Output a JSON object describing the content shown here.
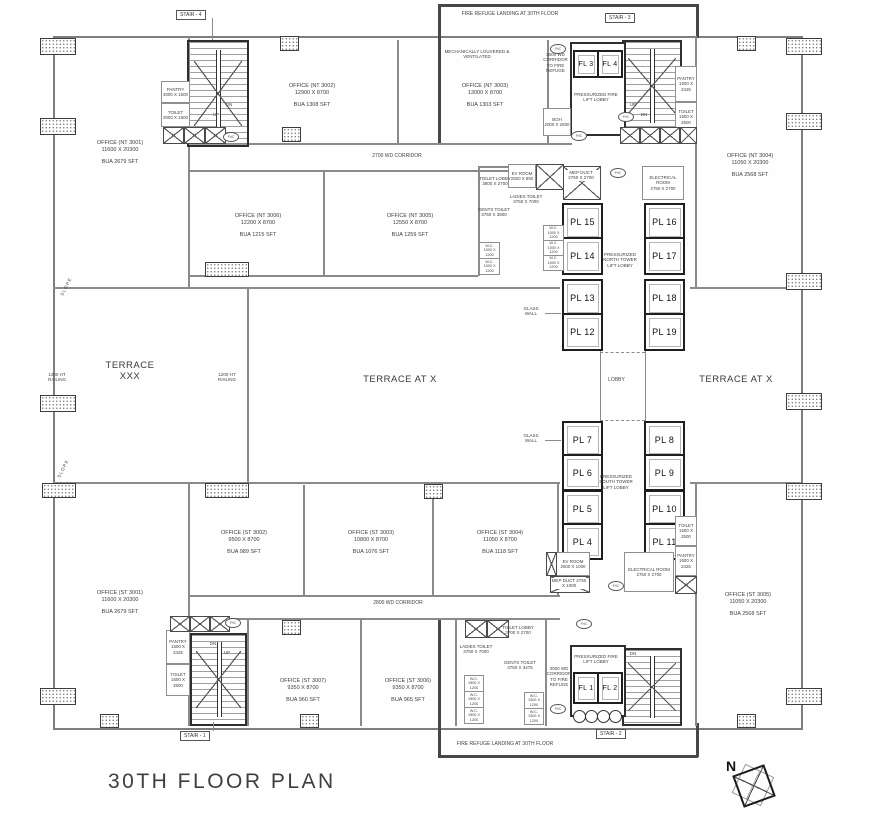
{
  "title": "30TH FLOOR PLAN",
  "north": {
    "label": "N"
  },
  "refuge": {
    "top": "FIRE REFUGE LANDING AT 30TH FLOOR",
    "bottom": "FIRE REFUGE LANDING AT 30TH FLOOR"
  },
  "corridors": {
    "top": "2700 WD CORRIDOR",
    "bottom": "2800 WD CORRIDOR",
    "fire_top": "3000 WD CORRIDOR TO FIRE REFUGE",
    "fire_bottom": "3000 WD CORRIDOR TO FIRE REFUGE"
  },
  "stairs": {
    "s1": "STAIR - 1",
    "s2": "STAIR - 2",
    "s3": "STAIR - 3",
    "s4": "STAIR - 4",
    "up": "UP",
    "dn": "DN"
  },
  "offices": {
    "nt3001": {
      "name": "OFFICE (NT 3001)",
      "dims": "11600 X 20300",
      "area": "BUA 2679 SFT"
    },
    "nt3002": {
      "name": "OFFICE (NT 3002)",
      "dims": "12900 X 8700",
      "area": "BUA 1308 SFT"
    },
    "nt3003": {
      "name": "OFFICE (NT 3003)",
      "dims": "13000 X 8700",
      "area": "BUA 1303 SFT"
    },
    "nt3004": {
      "name": "OFFICE (NT 3004)",
      "dims": "11050 X 20300",
      "area": "BUA 2568 SFT"
    },
    "nt3005": {
      "name": "OFFICE (NT 3005)",
      "dims": "12550 X 8700",
      "area": "BUA 1259 SFT"
    },
    "nt3006": {
      "name": "OFFICE (NT 3006)",
      "dims": "12200 X 8700",
      "area": "BUA 1215 SFT"
    },
    "st3001": {
      "name": "OFFICE (ST 3001)",
      "dims": "11600 X 20300",
      "area": "BUA 2679 SFT"
    },
    "st3002": {
      "name": "OFFICE (ST 3002)",
      "dims": "9500 X 8700",
      "area": "BUA 989 SFT"
    },
    "st3003": {
      "name": "OFFICE (ST 3003)",
      "dims": "10800 X 8700",
      "area": "BUA 1076 SFT"
    },
    "st3004": {
      "name": "OFFICE (ST 3004)",
      "dims": "11050 X 8700",
      "area": "BUA 1118 SFT"
    },
    "st3005": {
      "name": "OFFICE (ST 3005)",
      "dims": "11050 X 20300",
      "area": "BUA 2568 SFT"
    },
    "st3006": {
      "name": "OFFICE (ST 3006)",
      "dims": "9350 X 8700",
      "area": "BUA 965 SFT"
    },
    "st3007": {
      "name": "OFFICE (ST 3007)",
      "dims": "9350 X 8700",
      "area": "BUA 960 SFT"
    }
  },
  "terraces": {
    "xxx_line1": "TERRACE",
    "xxx_line2": "XXX",
    "center": "TERRACE AT X",
    "right": "TERRACE AT X",
    "lobby": "LOBBY",
    "railing": "1200 HT RAILING",
    "slope": "SLOPE",
    "glass_wall": "GLASS WALL"
  },
  "lift_lobbies": {
    "north": "PRESSURIZED NORTH TOWER LIFT LOBBY",
    "south": "PRESSURIZED SOUTH TOWER LIFT LOBBY",
    "fire": "PRESSURIZED FIRE LIFT LOBBY"
  },
  "lifts": {
    "pl4": "PL 4",
    "pl5": "PL 5",
    "pl6": "PL 6",
    "pl7": "PL 7",
    "pl8": "PL 8",
    "pl9": "PL 9",
    "pl10": "PL 10",
    "pl11": "PL 11",
    "pl12": "PL 12",
    "pl13": "PL 13",
    "pl14": "PL 14",
    "pl15": "PL 15",
    "pl16": "PL 16",
    "pl17": "PL 17",
    "pl18": "PL 18",
    "pl19": "PL 19",
    "fl1": "FL 1",
    "fl2": "FL 2",
    "fl3": "FL 3",
    "fl4": "FL 4"
  },
  "rooms": {
    "mech_note": "MECHANICALLY LOUVERED & VENTILATED",
    "pantry_a": {
      "name": "PANTRY",
      "dims": "3000 X 1500"
    },
    "toilet_a": {
      "name": "TOILET",
      "dims": "3000 X 1500"
    },
    "pantry_b": {
      "name": "PANTRY",
      "dims": "1500 X 2425"
    },
    "toilet_b": {
      "name": "TOILET",
      "dims": "1500 X 2500"
    },
    "boh": {
      "name": "BOH",
      "dims": "2000 X 2600"
    },
    "toilet_lobby_n": {
      "name": "TOILET LOBBY",
      "dims": "3800 X 2700"
    },
    "toilet_lobby_s": {
      "name": "TOILET LOBBY",
      "dims": "3700 X 2700"
    },
    "ev_n": {
      "name": "EV ROOM",
      "dims": "2500 X 850"
    },
    "ev_s": {
      "name": "EV ROOM",
      "dims": "2500 X 1000"
    },
    "mep_n": {
      "name": "MEP DUCT",
      "dims": "2750 X 2700"
    },
    "mep_s": {
      "name": "MEP DUCT",
      "dims": "2750 X 1000"
    },
    "elec": {
      "name": "ELECTRICAL ROOM",
      "dims": "2750 X 2700"
    },
    "gents_n": {
      "name": "GENTS TOILET",
      "dims": "3750 X 3800"
    },
    "gents_s": {
      "name": "GENTS TOILET",
      "dims": "3750 X 3475"
    },
    "ladies": {
      "name": "LADIES TOILET",
      "dims": "3750 X 7000"
    },
    "wc": {
      "name": "W.C.",
      "dims": "1500 X 1200"
    }
  },
  "tags": {
    "fhc": "FHC"
  }
}
